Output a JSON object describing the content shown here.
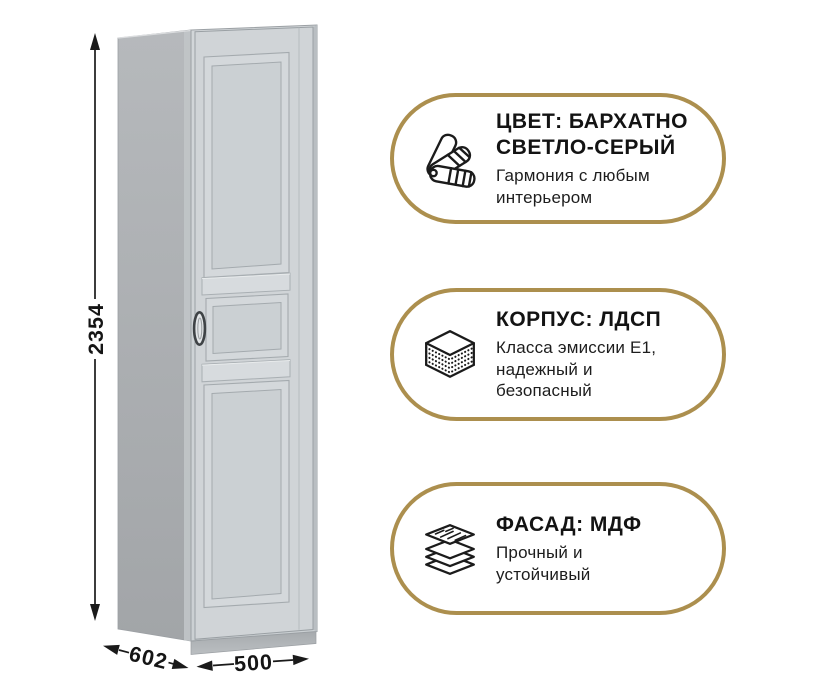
{
  "colors": {
    "background": "#ffffff",
    "accent_gold": "#AC8F4E",
    "ink": "#1a1a1a",
    "cabinet_side_gray": "#aaacae",
    "cabinet_front_gray": "#ced3d6"
  },
  "dimensions": {
    "height": "2354",
    "depth": "602",
    "width": "500"
  },
  "callouts": [
    {
      "icon": "color-fan-icon",
      "title": "ЦВЕТ: БАРХАТНО\nСВЕТЛО-СЕРЫЙ",
      "subtitle": "Гармония с любым\nинтерьером"
    },
    {
      "icon": "chipboard-layers-icon",
      "title": "КОРПУС: ЛДСП",
      "subtitle": "Класса эмиссии Е1,\nнадежный и\nбезопасный"
    },
    {
      "icon": "mdf-sheets-icon",
      "title": "ФАСАД: МДФ",
      "subtitle": "Прочный и\nустойчивый"
    }
  ]
}
